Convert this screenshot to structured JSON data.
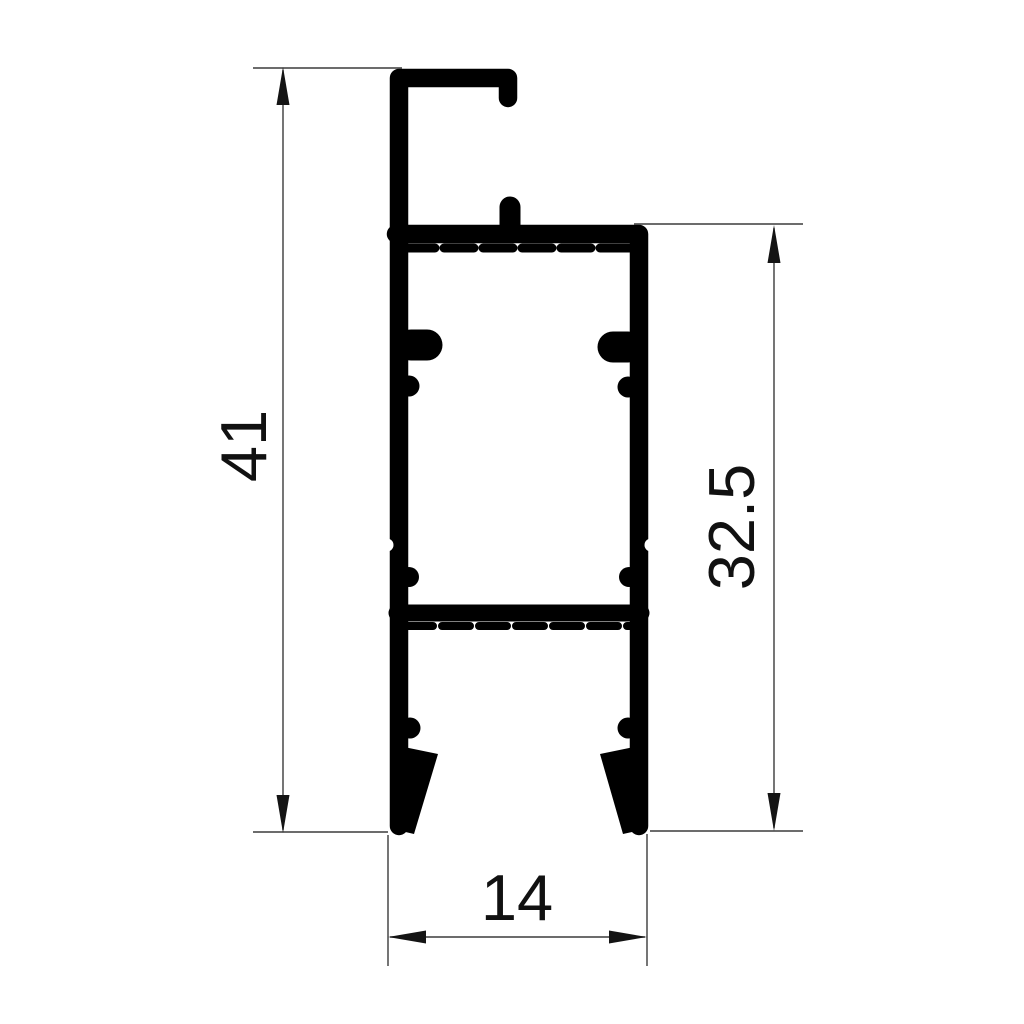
{
  "drawing": {
    "labels": {
      "total_height": "41",
      "side_height": "32.5",
      "bottom_width": "14"
    },
    "colors": {
      "profile": "#000000",
      "dimension_line": "#3b3b3b",
      "text": "#111111",
      "background": "#ffffff"
    }
  }
}
